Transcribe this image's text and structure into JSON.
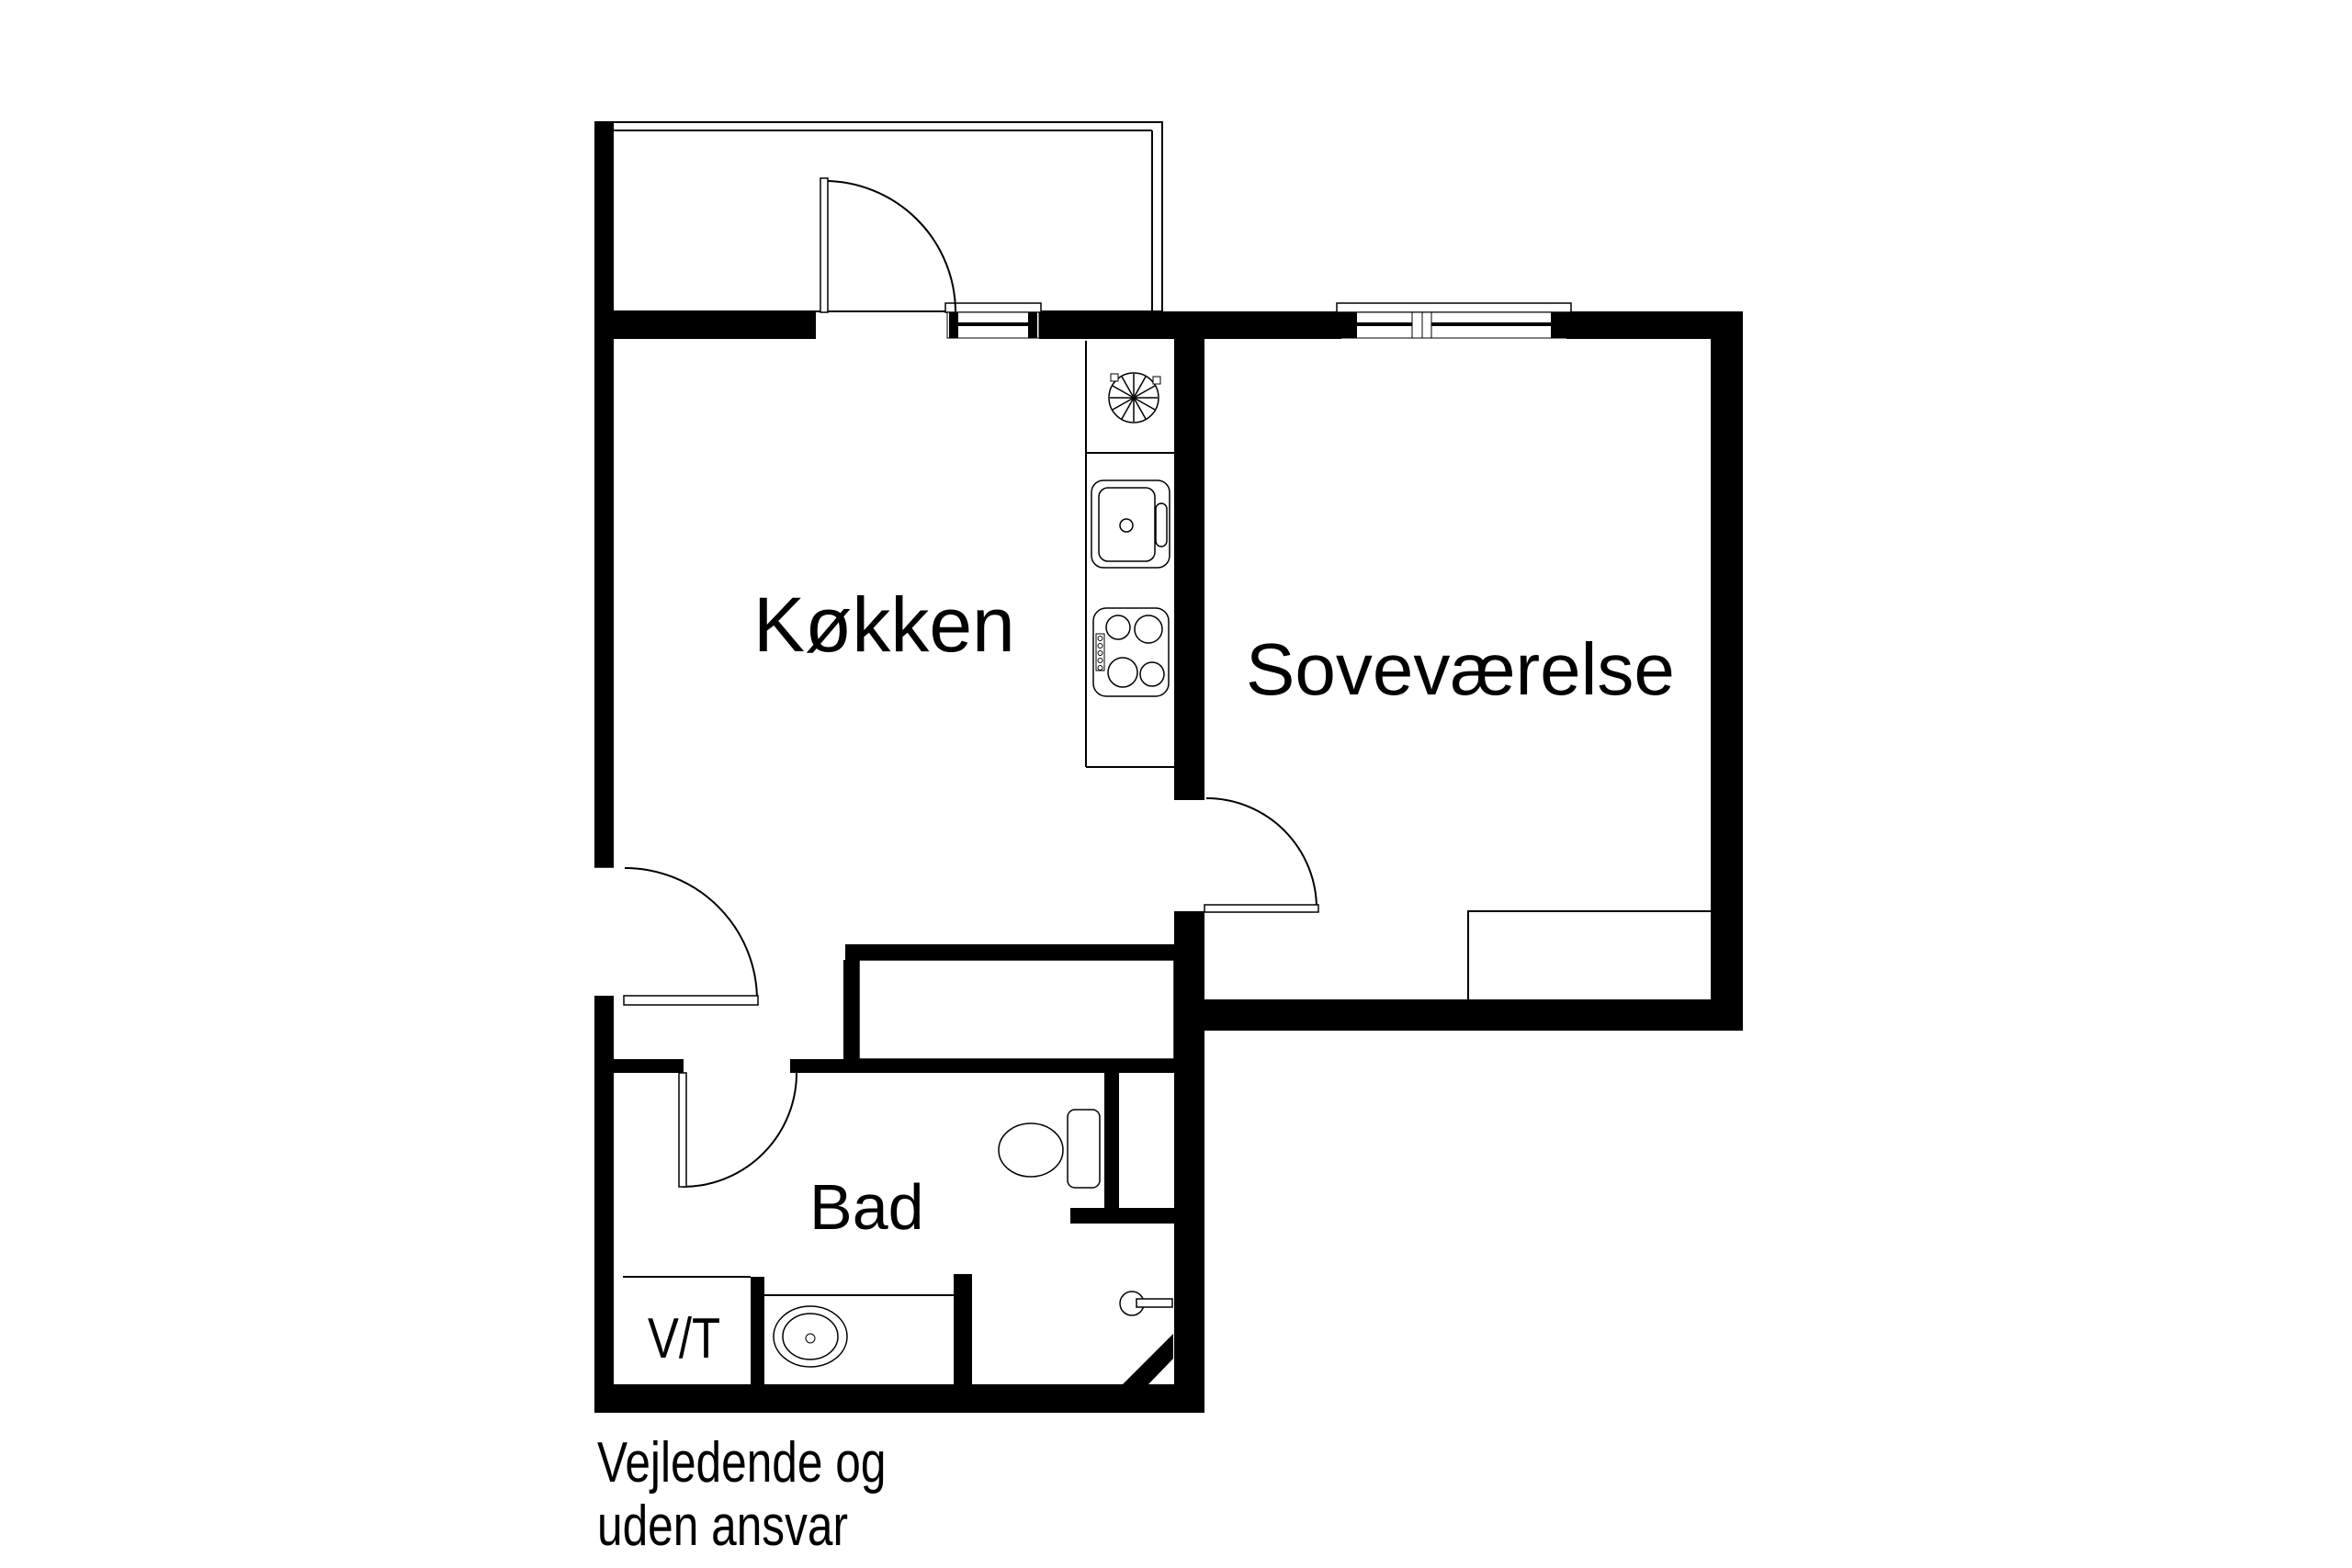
{
  "page": {
    "background_color": "#ffffff",
    "ink_color": "#000000"
  },
  "floor_plan": {
    "rooms": [
      {
        "id": "kitchen",
        "label": "Køkken"
      },
      {
        "id": "bedroom",
        "label": "Soveværelse"
      },
      {
        "id": "bathroom",
        "label": "Bad"
      },
      {
        "id": "vt-closet",
        "label": "V/T"
      }
    ],
    "disclaimer": {
      "line1": "Vejledende og",
      "line2": "uden ansvar"
    },
    "fixtures": [
      "balcony-outline",
      "balcony-door",
      "entry-door",
      "bathroom-door",
      "bedroom-door",
      "kitchen-window",
      "bedroom-window",
      "extractor-fan",
      "kitchen-sink",
      "stove",
      "closet-niche",
      "bed",
      "toilet",
      "floor-drain",
      "bathroom-sink",
      "diagonal-wall"
    ]
  }
}
